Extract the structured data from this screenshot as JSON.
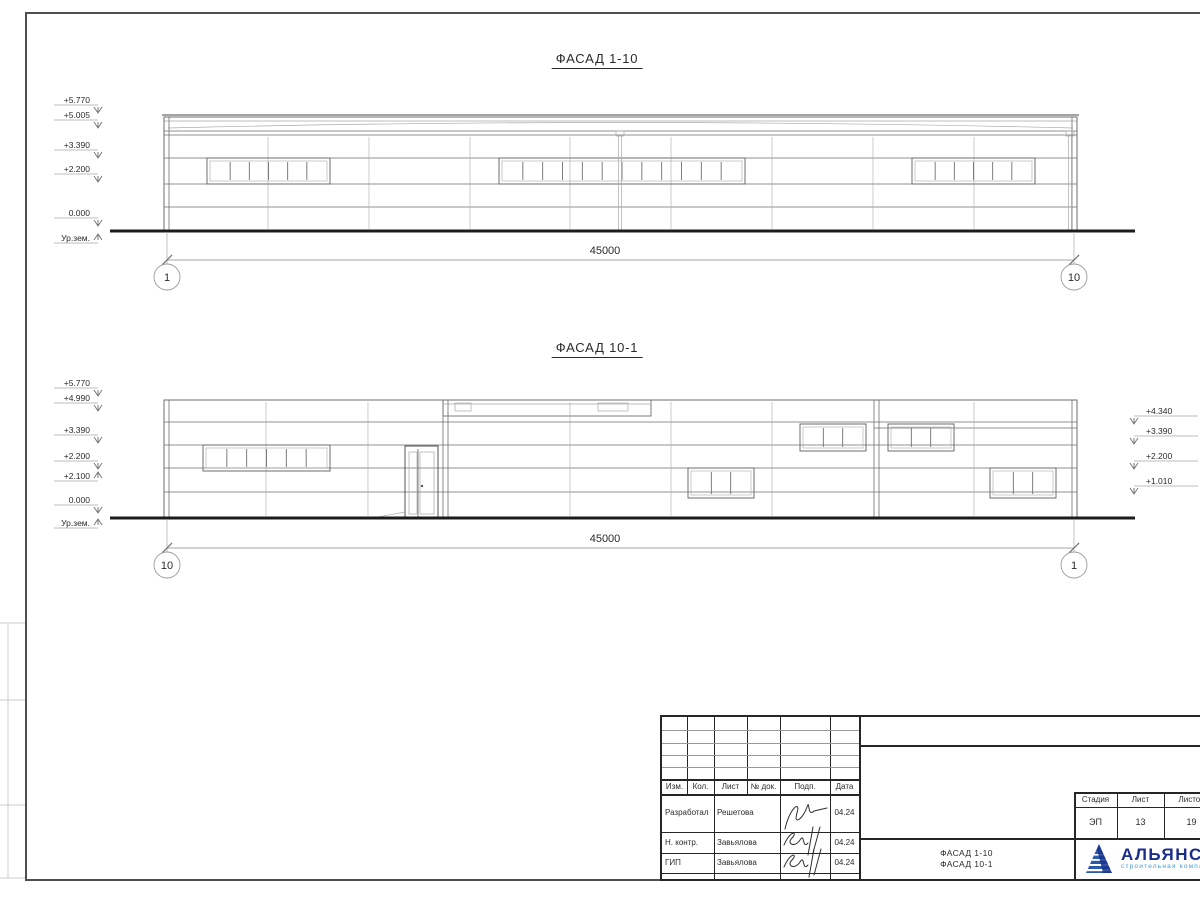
{
  "colors": {
    "paper": "#ffffff",
    "frame": "#4f4f4f",
    "line_dark": "#2b2b2b",
    "line_med": "#6e6e6e",
    "line_light": "#a9a9a9",
    "dim": "#8a8a8a",
    "ground": "#1c1c1c",
    "logo_navy": "#1b2d8a",
    "logo_blue": "#2b59ab",
    "logo_light_blue": "#3f9bd8"
  },
  "facade1": {
    "title": "ФАСАД 1-10",
    "dim_label": "45000",
    "axis_left_label": "1",
    "axis_right_label": "10",
    "marks_left": [
      {
        "label": "+5.770",
        "y": 103
      },
      {
        "label": "+5.005",
        "y": 118
      },
      {
        "label": "+3.390",
        "y": 148
      },
      {
        "label": "+2.200",
        "y": 172
      },
      {
        "label": "0.000",
        "y": 216
      },
      {
        "label": "Ур.зем.",
        "y": 241,
        "flip": true
      }
    ],
    "geo": {
      "left": 164,
      "right": 1077,
      "wall_top": 117,
      "cap_y": 115,
      "ground": 231,
      "fascia_lines": [
        121,
        131,
        135
      ],
      "hlines": [
        158,
        184,
        207
      ],
      "vlines": [
        268,
        369,
        470,
        570,
        671,
        772,
        873,
        974
      ],
      "windows": [
        {
          "x": 207,
          "y": 158,
          "w": 123,
          "h": 26,
          "panes": 6
        },
        {
          "x": 499,
          "y": 158,
          "w": 246,
          "h": 26,
          "panes": 12
        },
        {
          "x": 912,
          "y": 158,
          "w": 123,
          "h": 26,
          "panes": 6
        }
      ],
      "downspouts": [
        620,
        1070
      ],
      "ground_x": [
        110,
        1135
      ],
      "dim": {
        "y": 260,
        "x1": 167,
        "x2": 1074,
        "tx": 605,
        "ty": 254
      },
      "circle_y": 277
    }
  },
  "facade2": {
    "title": "ФАСАД 10-1",
    "dim_label": "45000",
    "axis_left_label": "10",
    "axis_right_label": "1",
    "marks_left": [
      {
        "label": "+5.770",
        "y": 386
      },
      {
        "label": "+4.990",
        "y": 401
      },
      {
        "label": "+3.390",
        "y": 433
      },
      {
        "label": "+2.200",
        "y": 459
      },
      {
        "label": "+2.100",
        "y": 479,
        "flip": true
      },
      {
        "label": "0.000",
        "y": 503
      },
      {
        "label": "Ур.зем.",
        "y": 526,
        "flip": true
      }
    ],
    "marks_right": [
      {
        "label": "+4.340",
        "y": 414
      },
      {
        "label": "+3.390",
        "y": 434
      },
      {
        "label": "+2.200",
        "y": 459
      },
      {
        "label": "+1.010",
        "y": 484
      }
    ],
    "geo": {
      "left": 164,
      "right": 1077,
      "top": 400,
      "ground": 518,
      "clerestory": {
        "x": 443,
        "w": 208,
        "y": 400,
        "h": 16,
        "inner_y": 404,
        "vents": [
          [
            455,
            403,
            16,
            8
          ],
          [
            598,
            403,
            30,
            8
          ]
        ]
      },
      "hlines": [
        [
          422,
          164,
          1077
        ],
        [
          445,
          164,
          1077
        ],
        [
          468,
          164,
          1077
        ],
        [
          492,
          164,
          1077
        ],
        [
          428,
          874,
          1077
        ]
      ],
      "vlines": [
        266,
        368,
        570,
        671,
        772,
        974
      ],
      "doubles": [
        443,
        874
      ],
      "windows": [
        {
          "x": 203,
          "y": 445,
          "w": 127,
          "h": 26,
          "panes": 6
        },
        {
          "x": 800,
          "y": 424,
          "w": 66,
          "h": 27,
          "panes": 3
        },
        {
          "x": 888,
          "y": 424,
          "w": 66,
          "h": 27,
          "panes": 3
        },
        {
          "x": 688,
          "y": 468,
          "w": 66,
          "h": 30,
          "panes": 3
        },
        {
          "x": 990,
          "y": 468,
          "w": 66,
          "h": 30,
          "panes": 3
        }
      ],
      "door": {
        "x": 405,
        "y": 446,
        "w": 33,
        "h": 72
      },
      "ground_x": [
        110,
        1135
      ],
      "dim": {
        "y": 548,
        "x1": 167,
        "x2": 1074,
        "tx": 605,
        "ty": 542
      },
      "circle_y": 565
    }
  },
  "titleblock": {
    "rev_headers": [
      "Изм.",
      "Кол.",
      "Лист",
      "№ док.",
      "Подп.",
      "Дата"
    ],
    "sign_rows": [
      {
        "role": "Разработал",
        "name": "Решетова",
        "date": "04.24"
      },
      {
        "role": "Н. контр.",
        "name": "Завьялова",
        "date": "04.24"
      },
      {
        "role": "ГИП",
        "name": "Завьялова",
        "date": "04.24"
      }
    ],
    "doc_line1": "ФАСАД 1-10",
    "doc_line2": "ФАСАД 10-1",
    "stage_headers": [
      "Стадия",
      "Лист",
      "Листов"
    ],
    "stage_values": [
      "ЭП",
      "13",
      "19"
    ],
    "logo": {
      "name": "АЛЬЯНС",
      "subtitle": "строительная компания"
    }
  }
}
